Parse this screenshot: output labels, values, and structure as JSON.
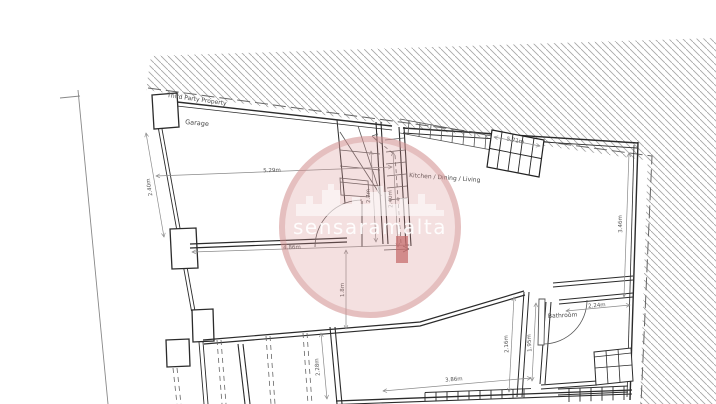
{
  "watermark": {
    "text": "sensaramalta",
    "color": "#cf8f8f"
  },
  "areas": {
    "third_party": "Third Party Property",
    "garage": "Garage",
    "kitchen": "Kitchen / Dining / Living",
    "bathroom": "Bathroom"
  },
  "dimensions": {
    "garage_width": "5.29m",
    "garage_side": "2.40m",
    "top_stair": "5.71m",
    "right_side": "3.46m",
    "stair_left": "2.7m",
    "stair_right": "2.40m",
    "living_width": "4.86m",
    "opening": "1.8m",
    "bottom_width": "3.86m",
    "hall": "2.16m",
    "bath_depth": "1.95m",
    "bath_width": "2.24m",
    "store_depth": "2.28m"
  },
  "colors": {
    "wall": "#2b2b2b",
    "dimension": "#8a8a8a",
    "hatch": "#a8a8a8",
    "watermark": "#cf8f8f"
  }
}
